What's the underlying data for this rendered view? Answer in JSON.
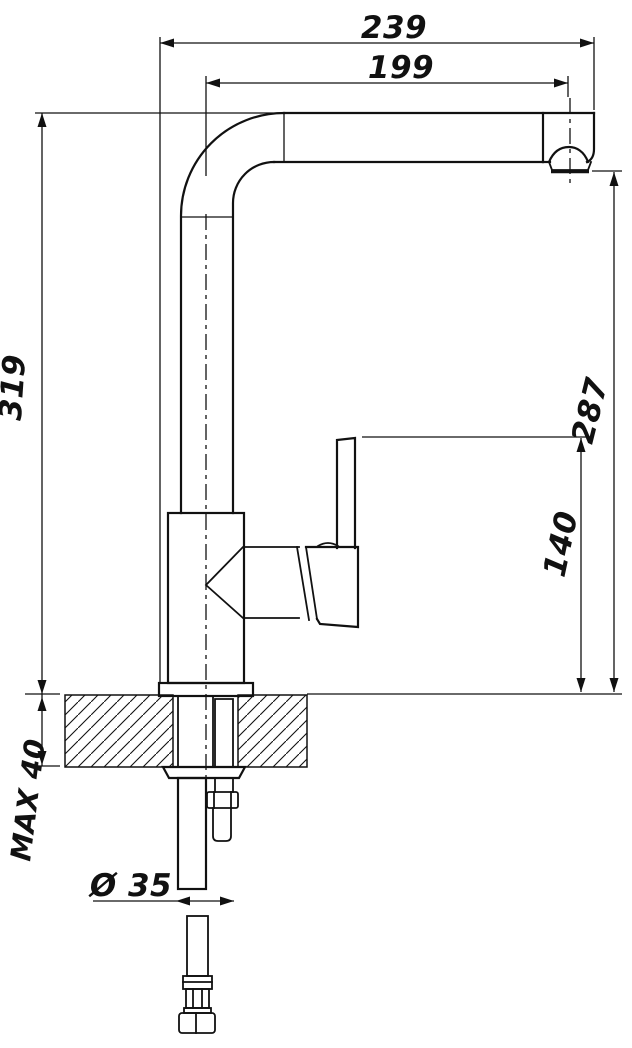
{
  "dimensions": {
    "overall_projection": "239",
    "spout_reach": "199",
    "spout_height": "319",
    "outlet_clearance": "287",
    "handle_clearance": "140",
    "max_counter_thickness": "MAX 40",
    "mounting_hole_diameter": "Ø 35"
  },
  "colors": {
    "line": "#111111",
    "background": "#ffffff"
  }
}
